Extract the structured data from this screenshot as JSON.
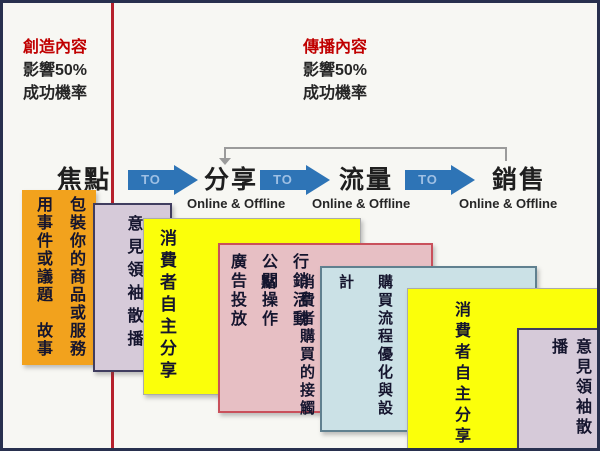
{
  "slide": {
    "left_panel": {
      "title": "創造內容",
      "impact": "影響50%",
      "success": "成功機率"
    },
    "right_panel": {
      "title": "傳播內容",
      "impact": "影響50%",
      "success": "成功機率"
    },
    "flow": {
      "focus": "焦點",
      "to": "TO",
      "stages": [
        {
          "label": "分享",
          "sub": "Online & Offline"
        },
        {
          "label": "流量",
          "sub": "Online & Offline"
        },
        {
          "label": "銷售",
          "sub": "Online & Offline"
        }
      ]
    },
    "cards": [
      {
        "name": "story-packaging",
        "columns": [
          "包裝你的商品或服務",
          "用事件或議題　故事"
        ]
      },
      {
        "name": "opinion-leader-seeding-left",
        "columns": [
          "意見領袖散播"
        ]
      },
      {
        "name": "consumer-sharing-left",
        "columns": [
          "消費者自主分享"
        ]
      },
      {
        "name": "marketing-tactics",
        "columns": [
          "行銷活動",
          "公關操作",
          "廣告投放"
        ]
      },
      {
        "name": "purchase-optimization",
        "columns": [
          "購買流程優化與設計",
          "消費者購買的接觸點"
        ]
      },
      {
        "name": "consumer-sharing-right",
        "columns": [
          "消費者自主分享"
        ]
      },
      {
        "name": "opinion-leader-seeding-right",
        "columns": [
          "意見領袖散播"
        ]
      }
    ],
    "colors": {
      "accent_red": "#C00000",
      "divider_red": "#B6202C",
      "arrow_blue": "#2E74B6",
      "connector_gray": "#9B9B9B",
      "orange": "#F2A21D",
      "lavender": "#D6CAD9",
      "yellow": "#FBFF0A",
      "pink": "#E7BFC4",
      "light_blue": "#CBE1E6"
    }
  }
}
